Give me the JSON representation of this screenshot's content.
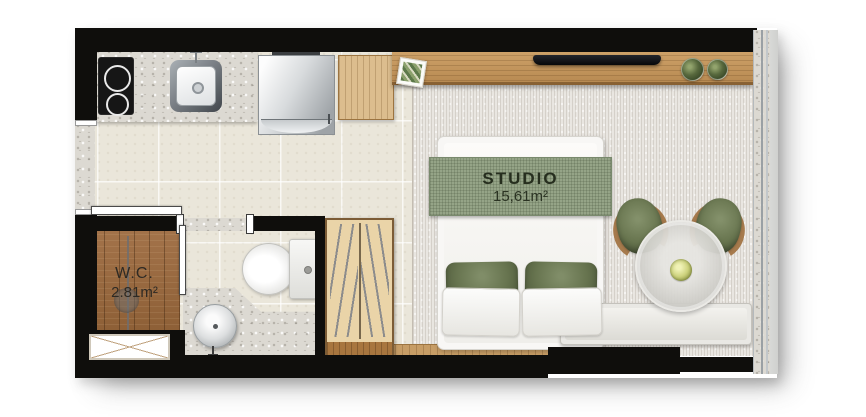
{
  "rooms": {
    "studio": {
      "label": "STUDIO",
      "area": "15,61m²"
    },
    "wc": {
      "label": "W.C.",
      "area": "2.81m²"
    }
  },
  "fixtures": {
    "kitchen": [
      "cooktop-2-burners",
      "stainless-sink",
      "refrigerator",
      "wood-cabinet"
    ],
    "living": [
      "tv",
      "console-shelf",
      "picture-frame",
      "plant-pot",
      "plant-pot",
      "round-dining-table",
      "armchair",
      "armchair",
      "window-bench",
      "flower-centerpiece"
    ],
    "sleeping": [
      "double-bed",
      "green-pillows",
      "white-pillows",
      "green-throw",
      "wardrobe-with-hangers"
    ],
    "bathroom": [
      "wood-deck-shower",
      "shower-column",
      "glass-partition",
      "sliding-door",
      "toilet",
      "round-washbasin",
      "granite-counter",
      "window"
    ]
  },
  "colors": {
    "wall": "#0f0e0c",
    "tile_floor": "#eae6da",
    "carpet": "#e9e6e1",
    "wood_shelf": "#c2945c",
    "wc_wood_floor": "#9a6a3d",
    "granite": "#dcd9d2",
    "accent_green": "#67744f",
    "throw_green": "#95a487"
  }
}
